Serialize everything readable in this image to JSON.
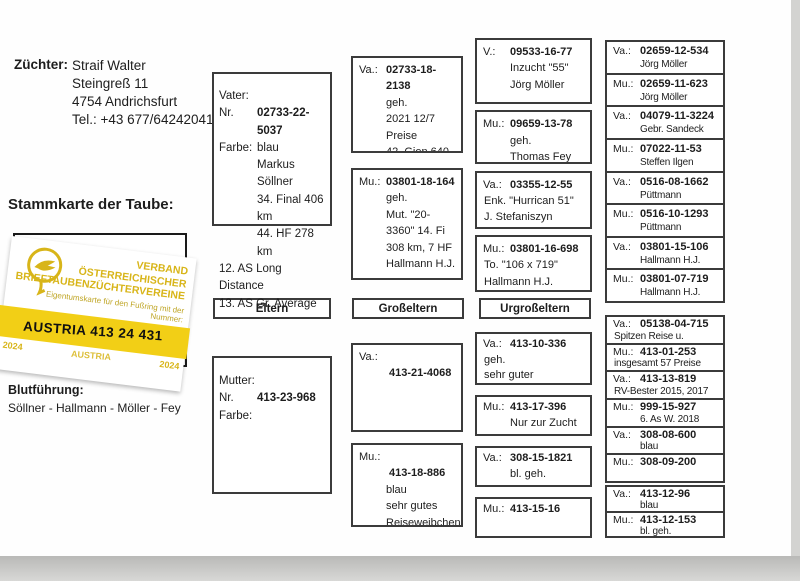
{
  "colors": {
    "card_yellow": "#f2cf16",
    "card_gold": "#d8b519",
    "ink": "#1d1d1d"
  },
  "header": {
    "breeder_label": "Züchter:",
    "breeder_lines": [
      "Straif Walter",
      "Steingreß 11",
      "4754 Andrichsfurt",
      "Tel.: +43 677/64242041"
    ],
    "pedigree_heading": "Stammkarte der Taube:",
    "bloodline_label": "Blutführung:",
    "bloodline_value": "Söllner - Hallmann - Möller - Fey"
  },
  "ownership_card": {
    "partial_letter": "M",
    "org_lines": [
      "VERBAND",
      "ÖSTERREICHISCHER",
      "BRIEFTAUBENZÜCHTERVEREINE"
    ],
    "subtitle": "Eigentumskarte für den Fußring mit der Nummer:",
    "ring_number": "AUSTRIA 413 24 431",
    "year_left": "2024",
    "country_watermark": "AUSTRIA",
    "year_right": "2024"
  },
  "generation_labels": {
    "parents": "Eltern",
    "grandparents": "Großeltern",
    "great_grandparents": "Urgroßeltern"
  },
  "father": {
    "title": "Vater:",
    "nr_label": "Nr.",
    "ring": "02733-22-5037",
    "farbe_label": "Farbe:",
    "farbe": "blau",
    "detail_lines": [
      "Markus Söllner",
      "34. Final 406 km",
      "44. HF 278 km"
    ],
    "footnotes": [
      "12. AS Long Distance",
      "13. AS Gr. Average"
    ]
  },
  "mother": {
    "title": "Mutter:",
    "nr_label": "Nr.",
    "ring": "413-23-968",
    "farbe_label": "Farbe:",
    "farbe": "",
    "detail_lines": [],
    "footnotes": []
  },
  "grandparents_paternal": [
    {
      "label": "Va.:",
      "ring": "02733-18-2138",
      "lines": [
        "geh.",
        "2021 12/7 Preise",
        "42. Gien 640 km",
        "Markus Söllner"
      ]
    },
    {
      "label": "Mu.:",
      "ring": "03801-18-164",
      "lines": [
        "geh.",
        "Mut. \"20-3360\" 14. Fi",
        "308 km, 7 HF",
        "Hallmann H.J."
      ],
      "flush": false
    }
  ],
  "grandparents_maternal": [
    {
      "label": "Va.:",
      "ring2": "413-21-4068"
    },
    {
      "label": "Mu.:",
      "ring2": "413-18-886",
      "lines": [
        "blau",
        "sehr gutes",
        "Reiseweibchen",
        "2020 10 Preise"
      ],
      "flush": false
    }
  ],
  "greatgrandparents_paternal": [
    {
      "label": "V.:",
      "ring": "09533-16-77",
      "lines": [
        "Inzucht \"55\"",
        "Jörg Möller"
      ]
    },
    {
      "label": "Mu.:",
      "ring": "09659-13-78",
      "lines": [
        "geh.",
        "Thomas Fey"
      ]
    },
    {
      "label": "Va.:",
      "ring": "03355-12-55",
      "lines": [
        "Enk. \"Hurrican 51\"",
        "J. Stefaniszyn"
      ],
      "flush": true
    },
    {
      "label": "Mu.:",
      "ring": "03801-16-698",
      "lines": [
        "To. \"106 x 719\"",
        "Hallmann H.J."
      ],
      "flush": true
    }
  ],
  "greatgrandparents_maternal": [
    {
      "label": "Va.:",
      "ring": "413-10-336",
      "lines": [
        "geh.",
        "sehr guter Reisevogel"
      ],
      "flush": true
    },
    {
      "label": "Mu.:",
      "ring": "413-17-396",
      "lines": [
        "Nur zur  Zucht"
      ]
    },
    {
      "label": "Va.:",
      "ring": "308-15-1821",
      "lines": [
        "bl. geh."
      ]
    },
    {
      "label": "Mu.:",
      "ring": "413-15-16",
      "lines": []
    }
  ],
  "gg2_paternal": [
    {
      "label": "Va.:",
      "ring": "02659-12-534",
      "lines": [
        "Jörg Möller"
      ]
    },
    {
      "label": "Mu.:",
      "ring": "02659-11-623",
      "lines": [
        "Jörg Möller"
      ]
    },
    {
      "label": "Va.:",
      "ring": "04079-11-3224",
      "lines": [
        "Gebr. Sandeck"
      ]
    },
    {
      "label": "Mu.:",
      "ring": "07022-11-53",
      "lines": [
        "Steffen Ilgen"
      ]
    },
    {
      "label": "Va.:",
      "ring": "0516-08-1662",
      "lines": [
        "Püttmann"
      ]
    },
    {
      "label": "Mu.:",
      "ring": "0516-10-1293",
      "lines": [
        "Püttmann"
      ]
    },
    {
      "label": "Va.:",
      "ring": "03801-15-106",
      "lines": [
        "Hallmann H.J."
      ]
    },
    {
      "label": "Mu.:",
      "ring": "03801-07-719",
      "lines": [
        "Hallmann H.J."
      ]
    }
  ],
  "gg2_maternal_a": [
    {
      "label": "Va.:",
      "ring": "05138-04-715",
      "lines": [
        "Spitzen Reise u. Zuchtvogel"
      ],
      "flush": true
    },
    {
      "label": "Mu.:",
      "ring": "413-01-253",
      "lines": [
        "insgesamt 57 Preise"
      ],
      "flush": true
    },
    {
      "label": "Va.:",
      "ring": "413-13-819",
      "lines": [
        "RV-Bester 2015, 2017"
      ],
      "flush": true
    },
    {
      "label": "Mu.:",
      "ring": "999-15-927",
      "lines": [
        "6. As W. 2018"
      ]
    },
    {
      "label": "Va.:",
      "ring": "308-08-600",
      "lines": [
        "blau"
      ]
    },
    {
      "label": "Mu.:",
      "ring": "308-09-200",
      "lines": []
    }
  ],
  "gg2_maternal_b": [
    {
      "label": "Va.:",
      "ring": "413-12-96",
      "lines": [
        "blau"
      ]
    },
    {
      "label": "Mu.:",
      "ring": "413-12-153",
      "lines": [
        "bl. geh."
      ]
    }
  ]
}
